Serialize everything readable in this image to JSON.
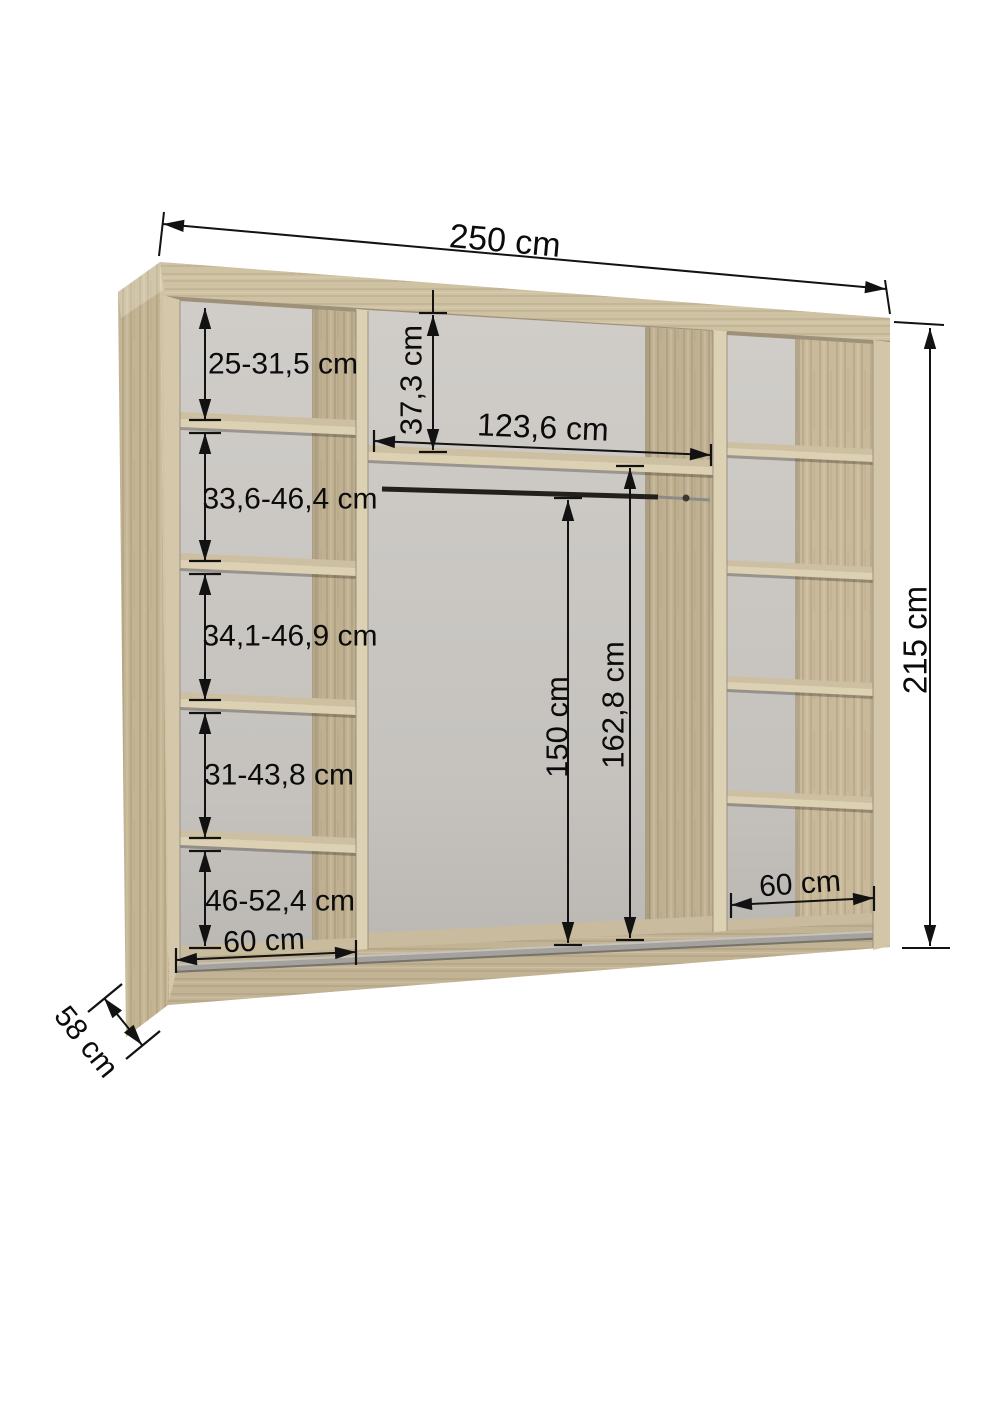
{
  "diagram": {
    "type": "wardrobe-interior-dimension-diagram",
    "unit": "cm",
    "labels": {
      "total_width": "250 cm",
      "total_height": "215 cm",
      "depth": "58 cm",
      "middle_width": "123,6 cm",
      "top_section_height": "37,3 cm",
      "rail_height": "150 cm",
      "middle_interior_height": "162,8 cm",
      "left_column_width": "60 cm",
      "right_column_width": "60 cm",
      "left_sections": [
        "25-31,5 cm",
        "33,6-46,4 cm",
        "34,1-46,9 cm",
        "31-43,8 cm",
        "46-52,4 cm"
      ]
    },
    "colors": {
      "wood_face": "#d1c4a6",
      "wood_fascia": "#cfc2a3",
      "wood_edge": "#ddd1b4",
      "wood_side": "#c3b494",
      "wood_partition": "#bfb091",
      "wood_inner_right": "#c8b99a",
      "wood_shelf_top": "#cdbfa1",
      "wood_floor": "#c9bb9d",
      "wood_plinth": "#c2b394",
      "back_wall": "#c9c6c2",
      "track": "#a5a29d",
      "rail_dark": "#22201c",
      "rail_gray": "#8e8b86",
      "line": "#121212"
    }
  }
}
